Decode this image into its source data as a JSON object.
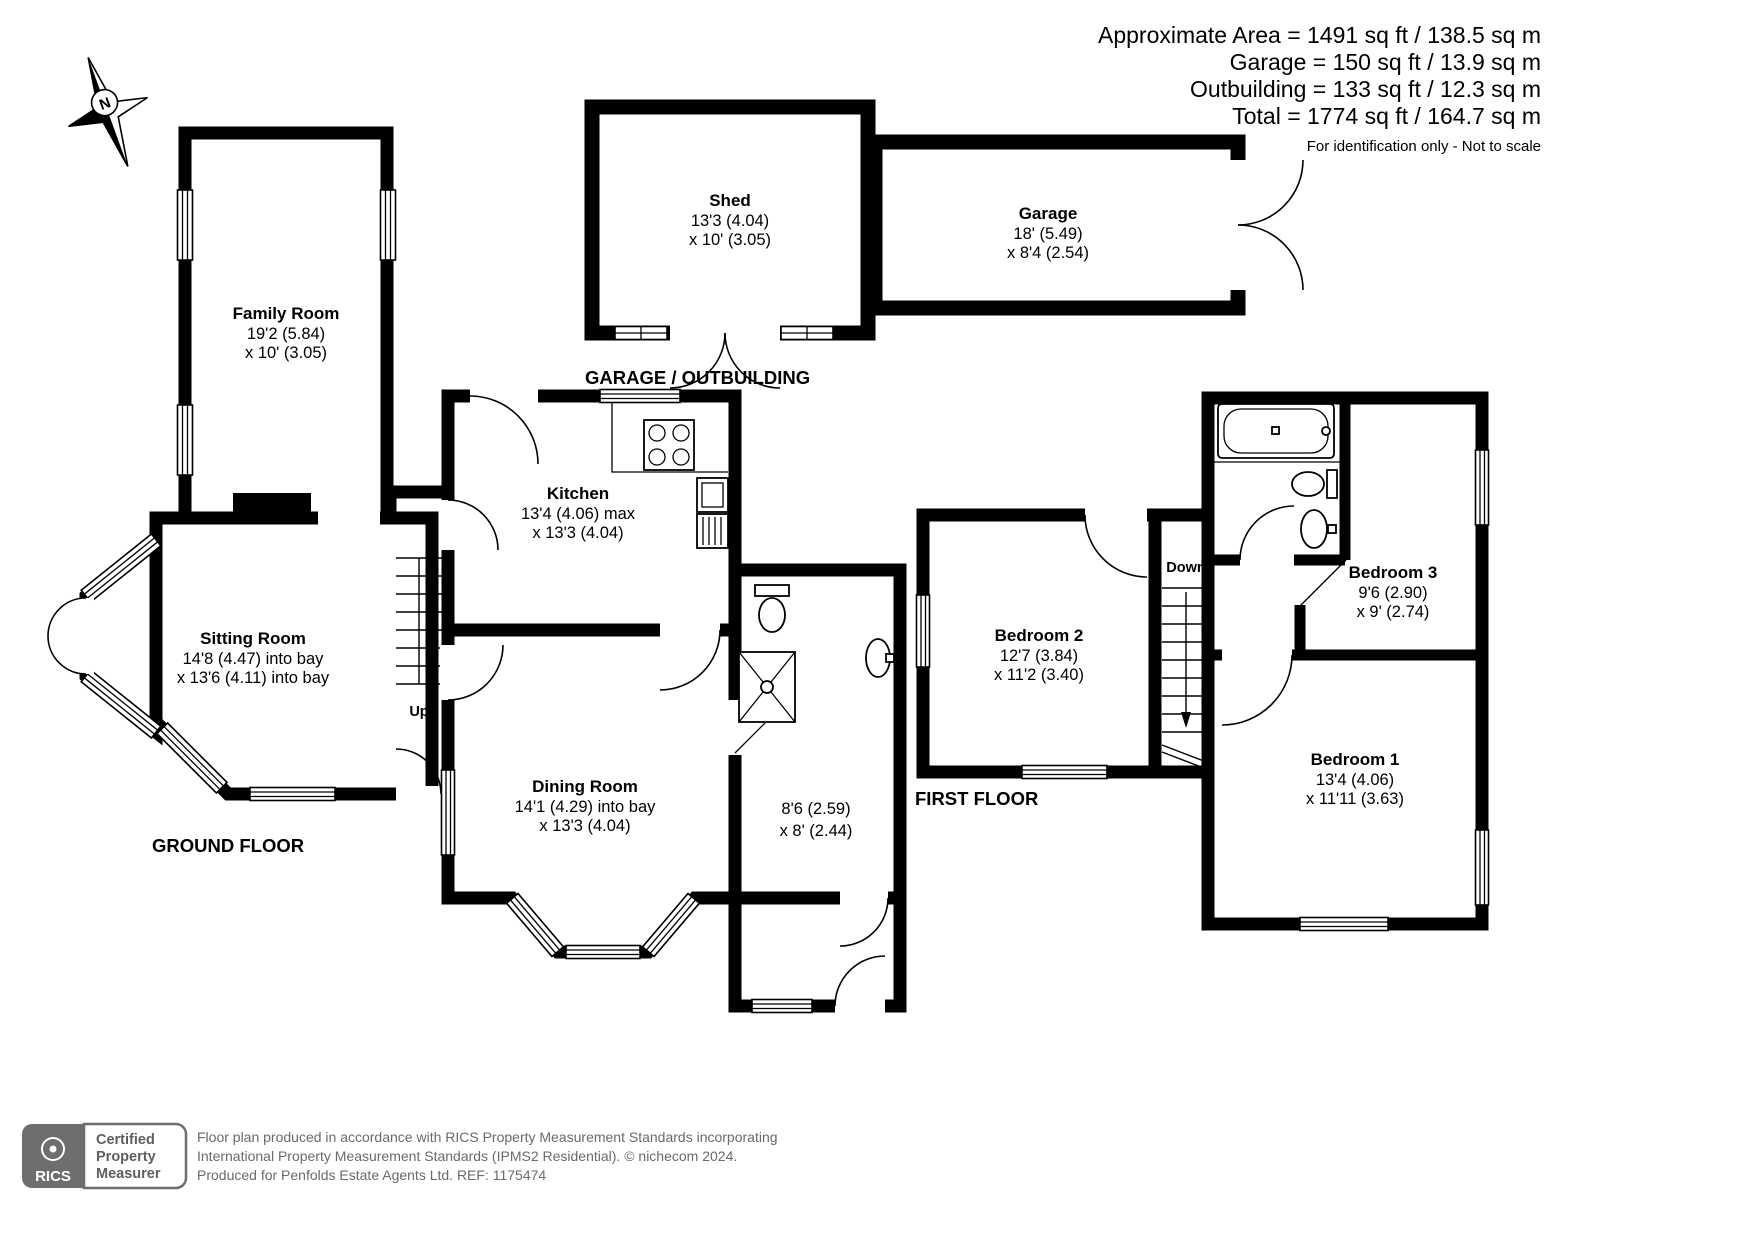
{
  "title_block": {
    "line1": "Approximate Area = 1491 sq ft / 138.5 sq m",
    "line2": "Garage = 150 sq ft / 13.9 sq m",
    "line3": "Outbuilding = 133 sq ft / 12.3 sq m",
    "line4": "Total = 1774 sq ft / 164.7 sq m",
    "note": "For identification only - Not to scale"
  },
  "floor_labels": {
    "ground": "GROUND FLOOR",
    "first": "FIRST FLOOR",
    "garage_outbuilding": "GARAGE / OUTBUILDING"
  },
  "stairs": {
    "up": "Up",
    "down": "Down"
  },
  "compass": {
    "north": "N"
  },
  "rooms": {
    "shed": {
      "name": "Shed",
      "dim1": "13'3 (4.04)",
      "dim2": "x 10' (3.05)"
    },
    "garage": {
      "name": "Garage",
      "dim1": "18' (5.49)",
      "dim2": "x 8'4 (2.54)"
    },
    "family_room": {
      "name": "Family Room",
      "dim1": "19'2 (5.84)",
      "dim2": "x 10' (3.05)"
    },
    "kitchen": {
      "name": "Kitchen",
      "dim1": "13'4 (4.06) max",
      "dim2": "x 13'3 (4.04)"
    },
    "sitting_room": {
      "name": "Sitting Room",
      "dim1": "14'8 (4.47) into bay",
      "dim2": "x 13'6 (4.11) into bay"
    },
    "dining_room": {
      "name": "Dining Room",
      "dim1": "14'1 (4.29) into bay",
      "dim2": "x 13'3 (4.04)"
    },
    "bathroom": {
      "dim1": "8'6 (2.59)",
      "dim2": "x 8' (2.44)"
    },
    "bedroom1": {
      "name": "Bedroom 1",
      "dim1": "13'4 (4.06)",
      "dim2": "x 11'11 (3.63)"
    },
    "bedroom2": {
      "name": "Bedroom 2",
      "dim1": "12'7 (3.84)",
      "dim2": "x 11'2 (3.40)"
    },
    "bedroom3": {
      "name": "Bedroom 3",
      "dim1": "9'6 (2.90)",
      "dim2": "x 9' (2.74)"
    }
  },
  "footer": {
    "rics": "RICS",
    "badge_line1": "Certified",
    "badge_line2": "Property",
    "badge_line3": "Measurer",
    "line1": "Floor plan produced in accordance with RICS Property Measurement Standards incorporating",
    "line2": "International Property Measurement Standards (IPMS2 Residential).  © nichecom 2024.",
    "line3": "Produced for Penfolds Estate Agents Ltd.   REF: 1175474"
  },
  "colors": {
    "wall": "#000000",
    "footer_gray": "#6a6a6a",
    "background": "#ffffff"
  }
}
